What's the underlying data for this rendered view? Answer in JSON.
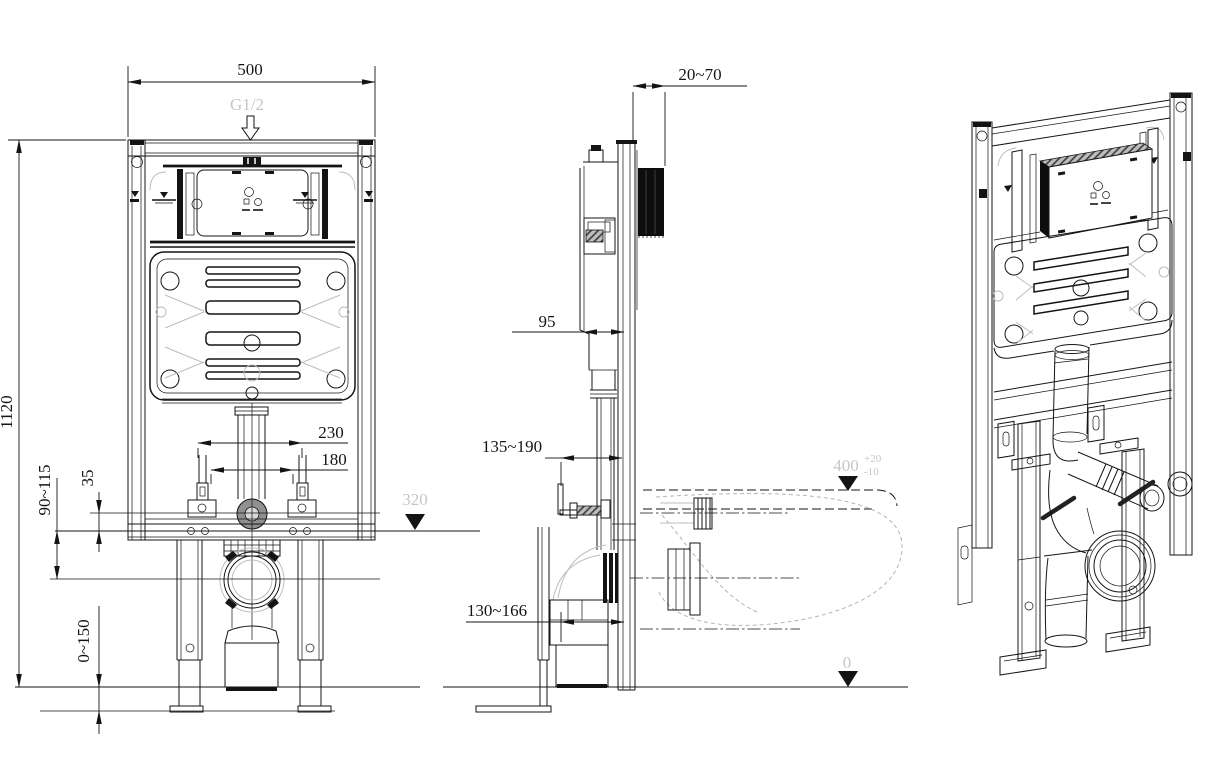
{
  "meta": {
    "background": "#ffffff",
    "line_color": "#141414",
    "ghost_line_color": "#bdbdbd",
    "ghost_text_color": "#c6c6c6"
  },
  "front_view": {
    "dims": {
      "width": "500",
      "height": "1120",
      "bolt_outer": "230",
      "bolt_inner": "180",
      "offset": "35",
      "outlet_height": "90~115",
      "leg_adjust": "0~150"
    },
    "labels": {
      "inlet_thread": "G1/2",
      "level_flush": "320"
    }
  },
  "side_view": {
    "dims": {
      "wall_distance": "20~70",
      "tank_depth": "95",
      "inlet_range": "135~190",
      "outlet_range": "130~166"
    },
    "labels": {
      "seat_height": "400",
      "seat_height_plus": "+20",
      "seat_height_minus": "-10",
      "floor_level": "0"
    }
  }
}
